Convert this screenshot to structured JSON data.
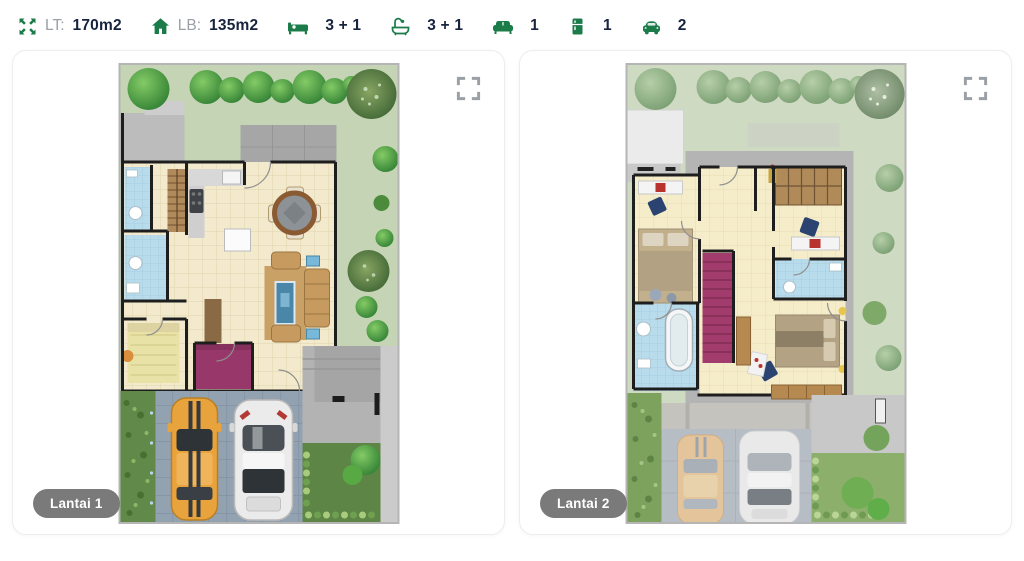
{
  "theme": {
    "accent_green": "#1b7b49",
    "text_dark": "#17233f",
    "label_gray": "#9aa0a5",
    "badge_bg": "#7a7a7a",
    "fullscreen_icon_gray": "#9aa0a6",
    "card_border": "#ededed"
  },
  "specs": {
    "items": [
      {
        "icon": "expand-icon",
        "label": "LT:",
        "value": "170m2"
      },
      {
        "icon": "home-icon",
        "label": "LB:",
        "value": "135m2"
      },
      {
        "icon": "bed-icon",
        "label": "",
        "value": "3 + 1"
      },
      {
        "icon": "bathtub-icon",
        "label": "",
        "value": "3 + 1"
      },
      {
        "icon": "sofa-icon",
        "label": "",
        "value": "1"
      },
      {
        "icon": "fridge-icon",
        "label": "",
        "value": "1"
      },
      {
        "icon": "car-icon",
        "label": "",
        "value": "2"
      }
    ]
  },
  "cards": [
    {
      "badge": "Lantai 1",
      "image": "floorplan-ground-floor"
    },
    {
      "badge": "Lantai 2",
      "image": "floorplan-second-floor"
    }
  ]
}
